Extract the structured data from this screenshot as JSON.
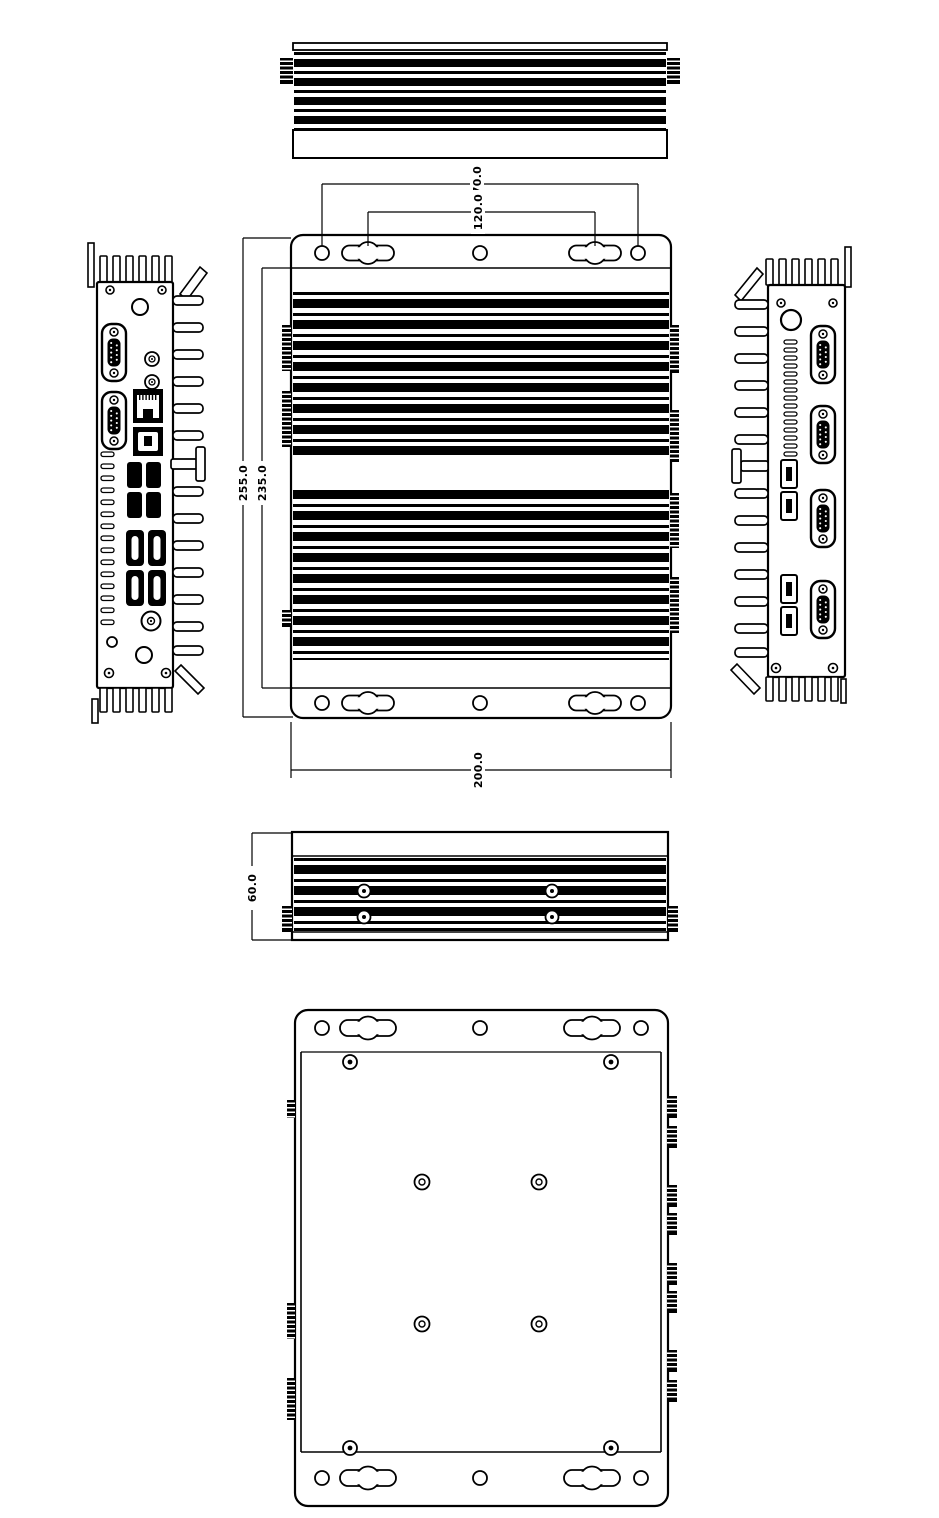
{
  "page": {
    "background": "#ffffff"
  },
  "drawing": {
    "line_color": "#000000",
    "dims": {
      "mount_hole_span": "170.0",
      "mount_slot_span": "120.0",
      "overall_height": "255.0",
      "body_height": "235.0",
      "overall_width": "200.0",
      "chassis_thickness": "60.0"
    },
    "depicted_ports": {
      "front_panel": {
        "db9_serial": 2,
        "ethernet": 2,
        "audio_jacks": 2,
        "usb": 4,
        "video": 4,
        "dc_jack": 1,
        "power_button": 1
      },
      "rear_panel": {
        "db9_serial": 4,
        "usb": 4,
        "antenna_hole": 1
      }
    }
  }
}
